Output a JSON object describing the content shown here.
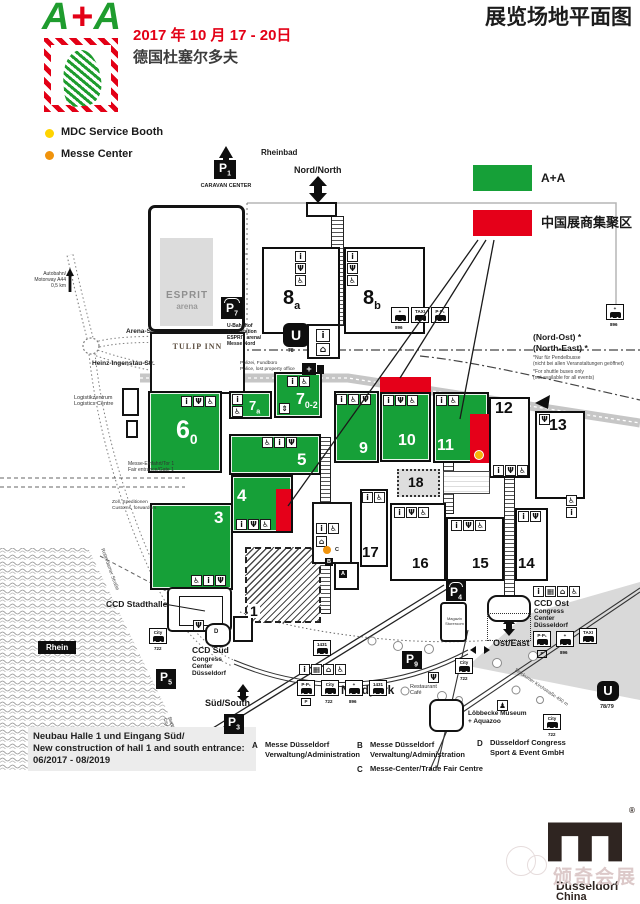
{
  "header": {
    "logo": {
      "a1": "A",
      "plus": "+",
      "a2": "A"
    },
    "date_line": "2017 年 10 月 17 - 20日",
    "city_line": "德国杜塞尔多夫",
    "page_title": "展览场地平面图"
  },
  "legend": {
    "mdc_label": "MDC Service Booth",
    "messe_center_label": "Messe Center",
    "green_label": "A+A",
    "red_label": "中国展商集聚区"
  },
  "colors": {
    "hall_green": "#16a038",
    "china_red": "#e50019",
    "mdc_yellow": "#ffd400",
    "messe_center_orange": "#f0930c"
  },
  "icons": {
    "info": "i",
    "rest": "Ψ",
    "wc": "♿",
    "lift": "⇕",
    "house": "⌂",
    "grid": "▦",
    "cross": "+",
    "walk": "♟",
    "u": "U"
  },
  "map": {
    "north": {
      "rheinbad": "Rheinbad",
      "nord": "Nord/North",
      "caravan": "CARAVAN CENTER"
    },
    "parking": {
      "p": "P",
      "n1": "1",
      "n3": "3",
      "n4": "4",
      "n5": "5",
      "n7": "7",
      "n9": "9"
    },
    "esprit": {
      "l1": "ESPRIT",
      "l2": "arena"
    },
    "tulip": "TULIP INN",
    "u78": "78",
    "u7879": "78/79",
    "u_text": "U-Bahnhof\nTram station\nESPRIT arena/\nMesse Nord",
    "polizei": "Polizei, Fundbüro\nPolice, lost property office",
    "autobahn": "Autobahn/\nMotorway A44\n0,5 km",
    "arena_str": "Arena-Str.",
    "heinz_str": "Heinz-Ingenstau-Str.",
    "logistik": "Logistikzentrum\nLogistics Centre",
    "zoll": "Zoll, Speditionen\nCustoms, forwarders",
    "einfahrt": "Messe-Einfahrt/Tor 1\nFair entrance/Gate 1",
    "nordost": {
      "l1": "(Nord-Ost) *",
      "l2": "(North-East) *",
      "fn1": "*Nur für Pendelbusse",
      "fn2": "(nicht bei allen Veranstaltungen geöffnet)",
      "fn3": "*For shuttle buses only",
      "fn4": "(not available for all events)"
    },
    "g": [
      {
        "num": "6",
        "sub": "0"
      },
      {
        "num": "7",
        "sub": "a"
      },
      {
        "num": "7",
        "sub": "0-2"
      },
      {
        "num": "5",
        "sub": ""
      },
      {
        "num": "4",
        "sub": ""
      },
      {
        "num": "3",
        "sub": ""
      },
      {
        "num": "9",
        "sub": ""
      },
      {
        "num": "10",
        "sub": ""
      },
      {
        "num": "11",
        "sub": ""
      }
    ],
    "w": [
      {
        "num": "8",
        "sub": "a"
      },
      {
        "num": "8",
        "sub": "b"
      },
      {
        "num": "12",
        "sub": ""
      },
      {
        "num": "13",
        "sub": ""
      },
      {
        "num": "14",
        "sub": ""
      },
      {
        "num": "15",
        "sub": ""
      },
      {
        "num": "16",
        "sub": ""
      },
      {
        "num": "17",
        "sub": ""
      }
    ],
    "hall18": "18",
    "hall1": "1",
    "ccd_stadthalle": "CCD Stadthalle",
    "ccd_sued": {
      "name": "CCD Süd",
      "l1": "Congress",
      "l2": "Center",
      "l3": "Düsseldorf"
    },
    "ccd_ost": {
      "name": "CCD Ost",
      "l1": "Congress",
      "l2": "Center",
      "l3": "Düsseldorf"
    },
    "rhein": "Rhein",
    "sued": "Süd/South",
    "ost": "Ost/East",
    "nordpark": "Nordpark",
    "restaurant": "Restaurant\nCafé",
    "loebbecke": "Löbbecke Museum\n+ Aquazoo",
    "magazin": "Magazin\nStoreroom",
    "letters": {
      "a": "A",
      "b": "B",
      "c": "C",
      "d": "D"
    },
    "bus": {
      "pp": "P·P₁",
      "city": "City",
      "taxi": "TAXI",
      "cross": "+",
      "p_badge": "P",
      "n722": "722",
      "n896": "896",
      "n1431": "1431"
    },
    "streets": {
      "stockumer": "Stockumer Kirchstraße 450 m",
      "rotterdamer": "Rotterdamer Straße",
      "stadtmitte": "Stadtmitte 4 km\nCity 4 km"
    }
  },
  "construction": {
    "l1": "Neubau Halle 1 und Eingang Süd/",
    "l2": "New construction of hall 1 and south entrance:",
    "l3": "06/2017 - 08/2019"
  },
  "abc": {
    "a1": "Messe Düsseldorf",
    "a2": "Verwaltung/Administration",
    "b1": "Messe Düsseldorf",
    "b2": "Verwaltung/Administration",
    "c1": "Messe-Center/Trade Fair Centre",
    "d1": "Düsseldorf Congress",
    "d2": "Sport & Event GmbH"
  },
  "footer": {
    "watermark": "颁奇会展",
    "brand1": "Düsseldorf",
    "brand2": "China",
    "reg": "®"
  }
}
